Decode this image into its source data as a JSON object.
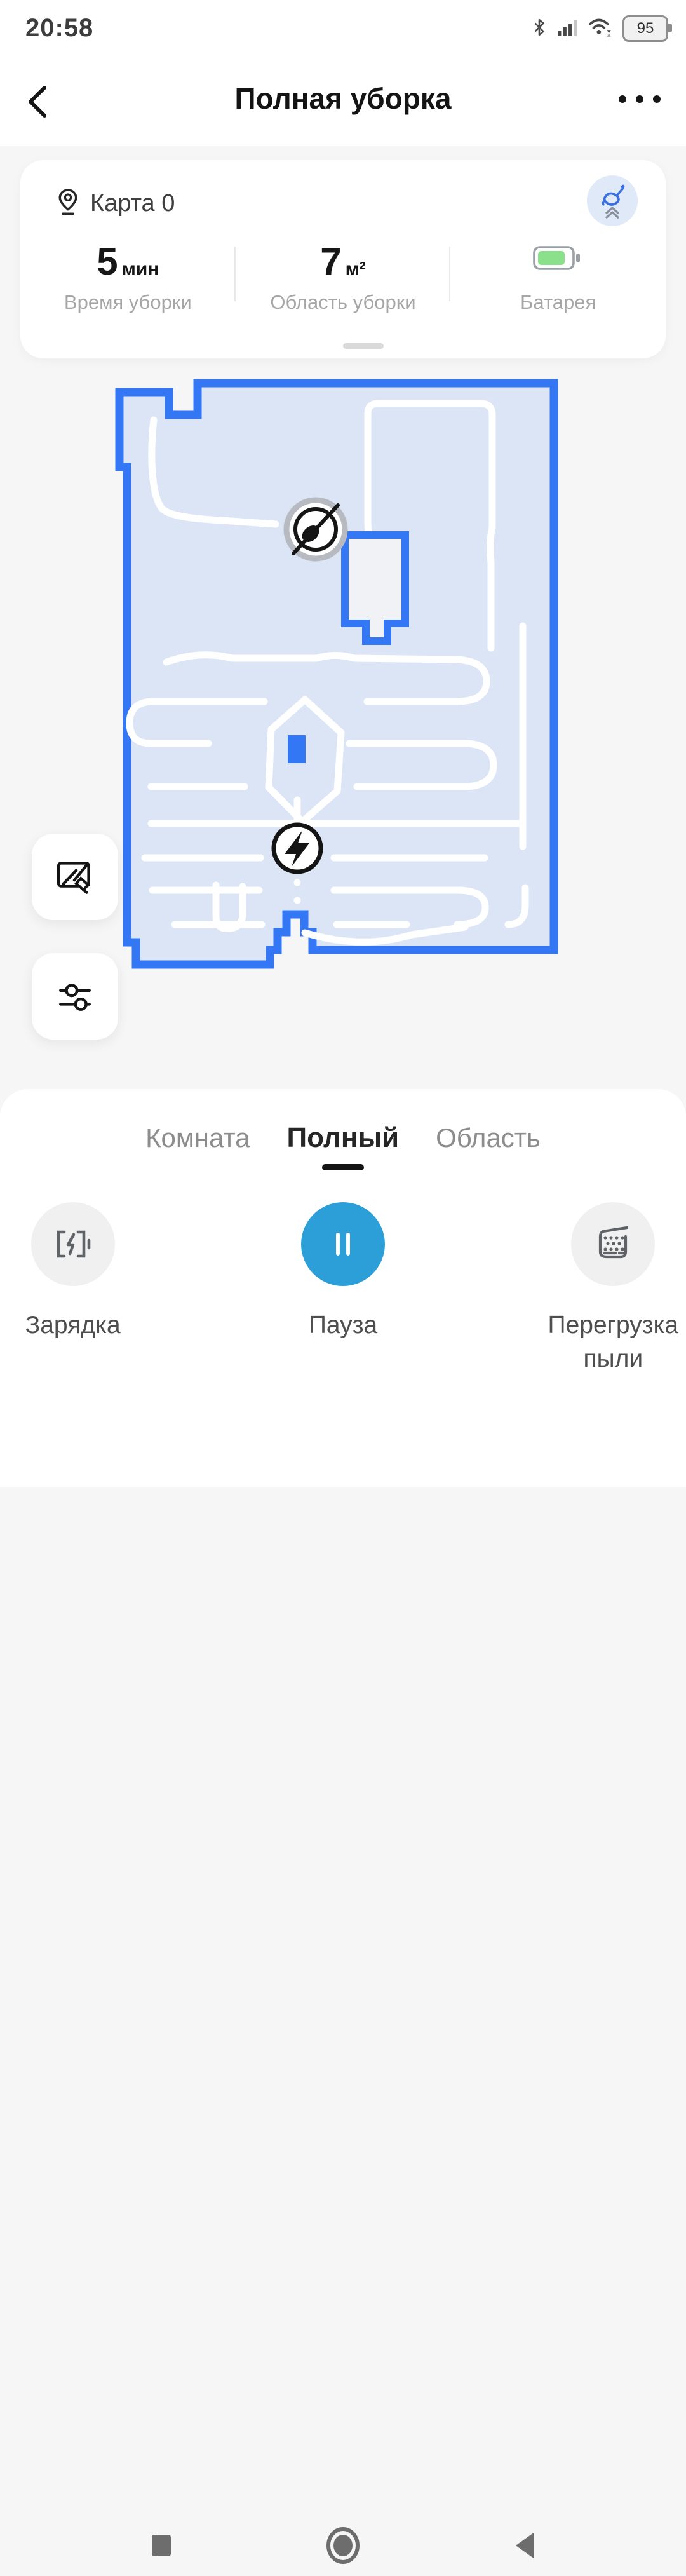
{
  "status_bar": {
    "time": "20:58",
    "battery_percent": "95",
    "icons": [
      "bluetooth-icon",
      "signal-icon",
      "wifi-icon",
      "battery-icon"
    ]
  },
  "header": {
    "title": "Полная уборка",
    "back_icon": "chevron-left",
    "menu_icon": "more-dots"
  },
  "map_card": {
    "name": "Карта 0",
    "name_icon": "location-pin",
    "status_chip_icon": "mop-lift",
    "stats": [
      {
        "value": "5",
        "unit": "мин",
        "label": "Время уборки"
      },
      {
        "value": "7",
        "unit": "м²",
        "label": "Область уборки"
      },
      {
        "value": "",
        "unit": "",
        "label": "Батарея",
        "icon": "battery-green"
      }
    ]
  },
  "map": {
    "robot_marker": "robot-compass",
    "dock_marker": "charging-dock-lightning",
    "square_marker": "blue-square"
  },
  "side_buttons": [
    {
      "name": "map-edit"
    },
    {
      "name": "map-settings-sliders"
    }
  ],
  "bottom_sheet": {
    "tabs": [
      {
        "label": "Комната",
        "active": false
      },
      {
        "label": "Полный",
        "active": true
      },
      {
        "label": "Область",
        "active": false
      }
    ],
    "actions": [
      {
        "label": "Зарядка",
        "icon": "charge-battery"
      },
      {
        "label": "Пауза",
        "icon": "pause"
      },
      {
        "label": "Перегрузка пыли",
        "icon": "dust-collector"
      }
    ]
  },
  "nav_bar": {
    "icons": [
      "recents-square",
      "home-circle",
      "back-triangle"
    ]
  },
  "colors": {
    "map_blue": "#3377f5",
    "map_fill": "#dbe5f6",
    "pause_blue": "#2d9fd8",
    "battery_green": "#8be08b",
    "chip_bg": "#dfe9f8"
  }
}
